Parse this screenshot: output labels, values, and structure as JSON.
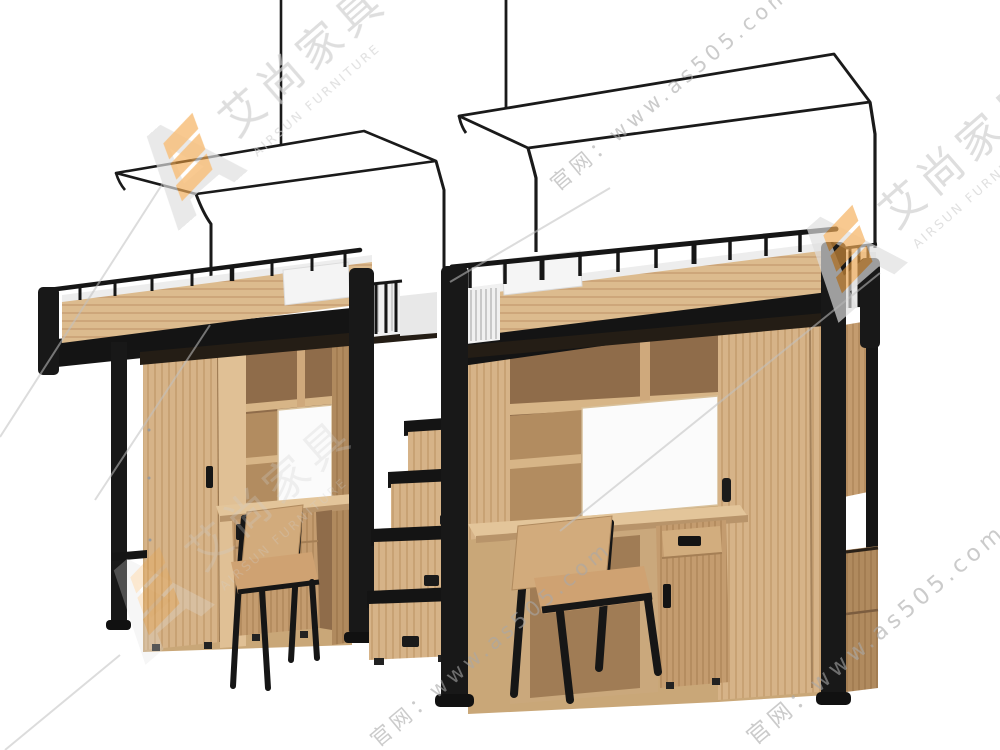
{
  "image": {
    "width": 1000,
    "height": 750,
    "description": "3D product render on white background: two wooden loft-bed units with black metal frames, mosquito-net canopy frames on top, wardrobes, bookshelves, desks and chairs below, connected by a storage staircase"
  },
  "watermark": {
    "logo_text": "AS",
    "brand_cn": "艾尚家具",
    "brand_en": "AIRSUN FURNITURE",
    "site_label_1": "官网：www.as505.com",
    "site_label_2": "官网：www.as505.com",
    "site_label_3": "官网：www.as505.com",
    "colors": {
      "logo_gray": "#dedede",
      "logo_orange": "#f3a240",
      "text_gray": "#a9a9a9"
    }
  },
  "colors": {
    "background": "#ffffff",
    "wood_light": "#d5b286",
    "wood_medium": "#c9a778",
    "wood_dark": "#b28a5d",
    "wood_shadow": "#8f6c4a",
    "metal_black": "#181818",
    "bedding_white": "#f2f2f2"
  }
}
